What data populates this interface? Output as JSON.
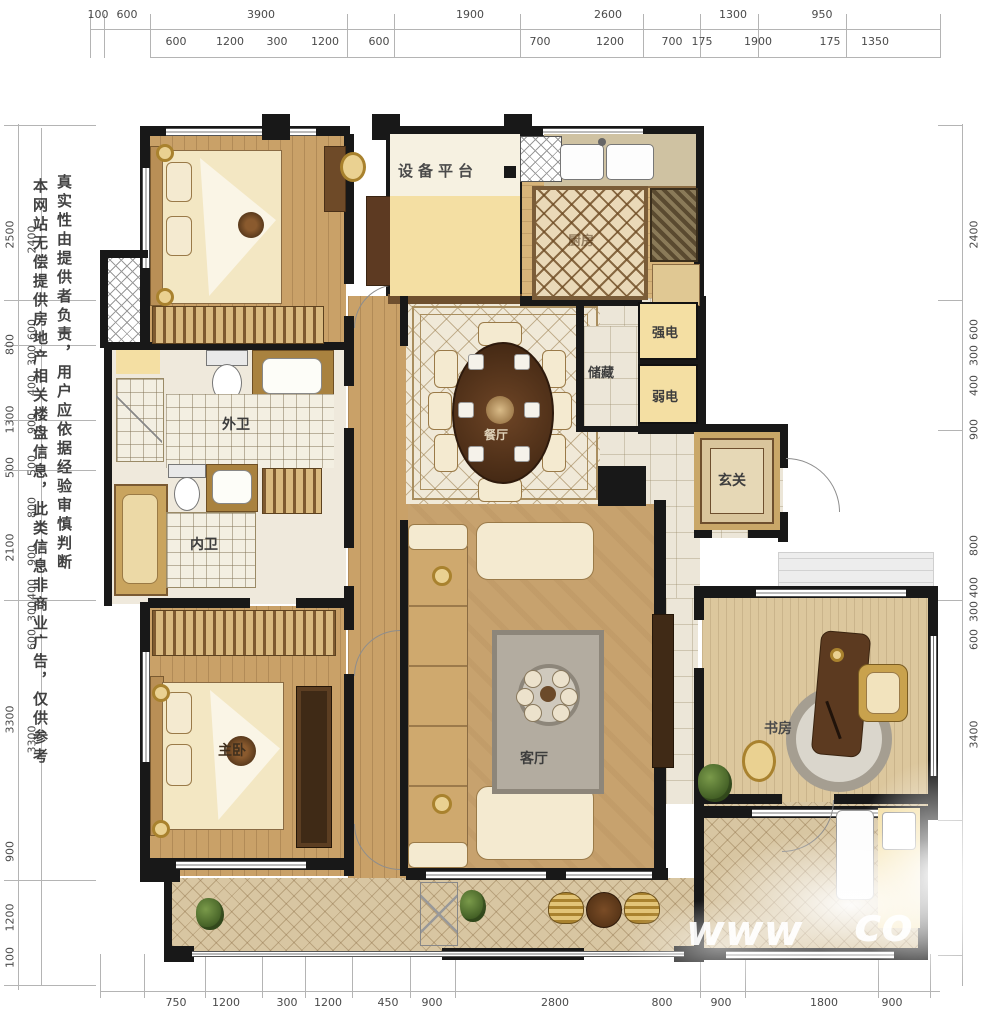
{
  "watermarks": {
    "disclaimer_col1": "本网站无偿提供房地产相关楼盘信息，此类信息非商业广告，仅供参考",
    "disclaimer_col2": "真实性由提供者负责，用户应依据经验审慎判断",
    "url_fragment_left": "www",
    "url_fragment_right": "co"
  },
  "rooms": {
    "equipment_platform": "设备平台",
    "kitchen": "厨房",
    "strong_electric": "强电",
    "storage": "储藏",
    "weak_electric": "弱电",
    "foyer": "玄关",
    "dining": "餐厅",
    "outer_bath": "外卫",
    "inner_bath": "内卫",
    "master_bedroom": "主卧",
    "living_room": "客厅",
    "study": "书房"
  },
  "dimensions": {
    "top_row1": [
      "100",
      "600",
      "3900",
      "1900",
      "2600",
      "1300",
      "950"
    ],
    "top_row2": [
      "600",
      "1200",
      "300",
      "1200",
      "600",
      "700",
      "1200",
      "700",
      "175",
      "1900",
      "175",
      "1350"
    ],
    "bottom": [
      "750",
      "1200",
      "300",
      "1200",
      "450",
      "900",
      "2800",
      "800",
      "900",
      "1800",
      "900"
    ],
    "left_outer": [
      "2500",
      "800",
      "1300",
      "500",
      "2100",
      "3300",
      "900",
      "1200",
      "100"
    ],
    "left_inner": [
      "2400",
      "600",
      "300",
      "400",
      "900",
      "500",
      "800",
      "900",
      "400",
      "300",
      "600",
      "3300"
    ],
    "right": [
      "2400",
      "600",
      "300",
      "400",
      "900",
      "800",
      "400",
      "300",
      "600",
      "3400"
    ]
  },
  "colors": {
    "wall": "#181818",
    "wood_floor": "#c9a168",
    "pale_yellow": "#f4dfa3",
    "tile": "#ece6d8",
    "dark_wood": "#5c3a20"
  }
}
